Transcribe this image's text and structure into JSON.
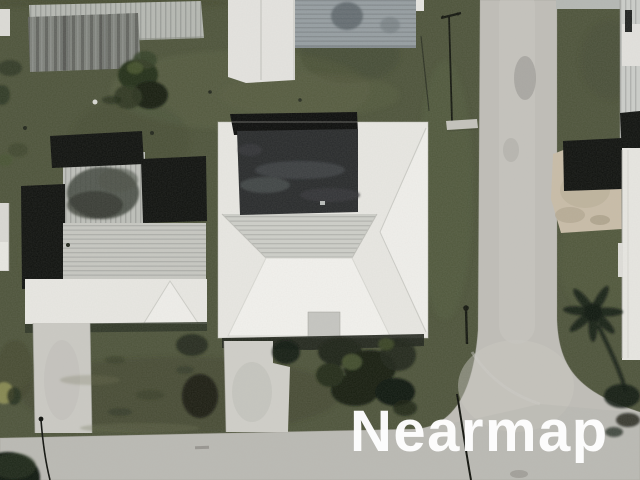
{
  "scene": {
    "kind": "aerial-map-imagery",
    "description": "Top-down aerial photograph of a residential block: houses with white hip roofs and gray shingle roofs, green lawns, concrete driveways, palm-tree shadows, and an L-shaped asphalt street meeting at a curved corner",
    "watermark": {
      "text": "Nearmap",
      "color": "#ffffff"
    },
    "palette": {
      "grass": "#4d5339",
      "grass_light": "#5d6343",
      "grass_dark": "#39402a",
      "road": "#bfbdb7",
      "road_light": "#cccac4",
      "driveway": "#cac9c3",
      "roof_white": "#e8e7e2",
      "roof_bright": "#f2f1ed",
      "roof_shingle": "#c6c7c1",
      "roof_blue_gray": "#959da1",
      "roof_dark": "#27292a",
      "shadow_black": "#0e100d",
      "dirt": "#c9bca6",
      "tree_dark": "#1c2415",
      "tree_green": "#3e4b2a"
    }
  }
}
